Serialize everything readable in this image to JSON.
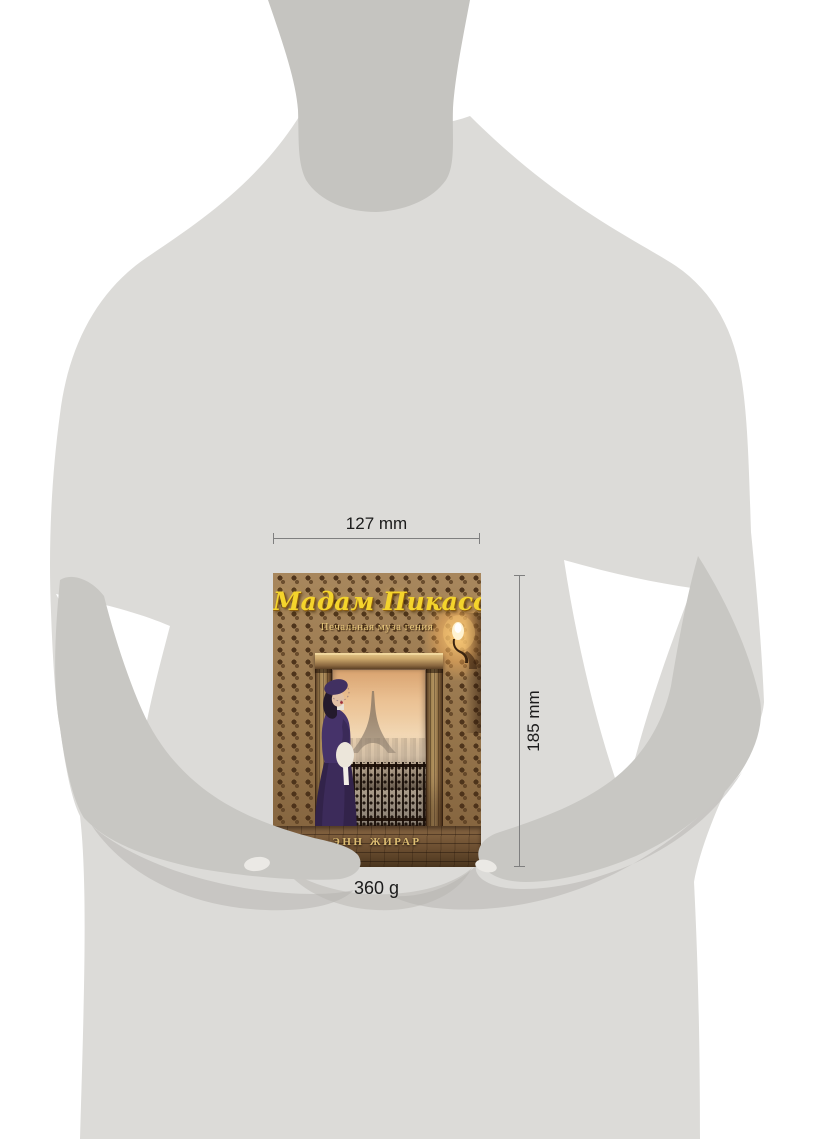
{
  "annotations": {
    "width_label": "127 mm",
    "height_label": "185 mm",
    "weight_label": "360 g"
  },
  "book_cover": {
    "title": "Мадам Пикассо",
    "subtitle": "Печальная муза гения",
    "author": "ЭНН ЖИРАР"
  },
  "colors": {
    "page_bg": "#ffffff",
    "body_grey": "#dcdbd8",
    "neck_grey": "#c5c4c0",
    "arm_grey": "#c8c7c3",
    "shadow_grey": "#b3b2ae",
    "dim_line": "#7f7f7f",
    "label_text": "#1b1b1b",
    "title_gold": "#f4d42c",
    "subtitle_gold": "#e8c87c",
    "author_gold": "#dcbc72",
    "wallpaper_base": "#9a7950",
    "sky_top": "#cf8f54",
    "sky_mid": "#f0d3ab",
    "city_haze": "#b7a793",
    "dress_purple": "#3d2b57",
    "muff_white": "#ece6da",
    "lamp_glow": "#ffcd78"
  }
}
